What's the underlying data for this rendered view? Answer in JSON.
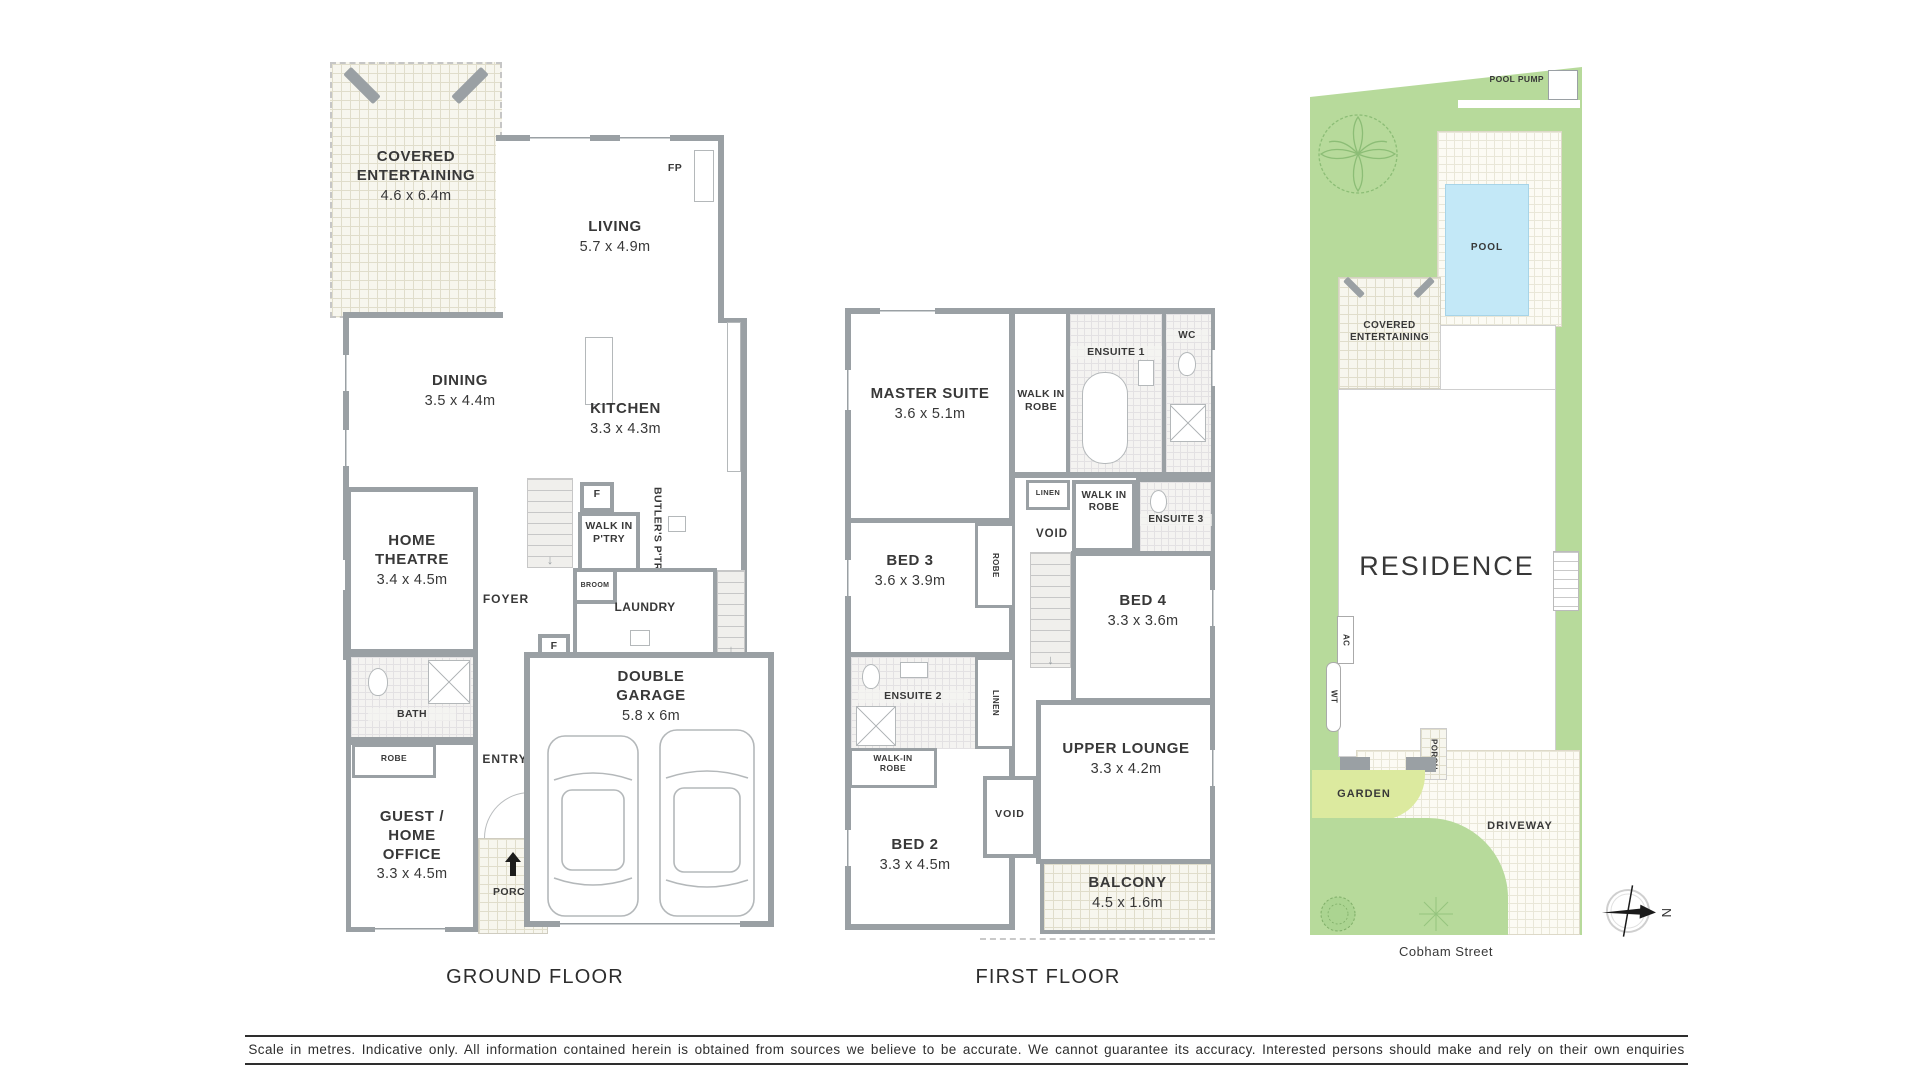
{
  "page": {
    "ground_floor_title": "GROUND FLOOR",
    "first_floor_title": "FIRST FLOOR",
    "street_name": "Cobham Street",
    "compass_north": "N",
    "disclaimer": "Scale in metres. Indicative only. All information contained herein is obtained from sources we believe to be accurate. We cannot guarantee its accuracy. Interested persons should make and rely on their own enquiries"
  },
  "colors": {
    "wall_grey": "#9aa0a4",
    "lawn_green": "#b7da9b",
    "garden_green": "#dcea9f",
    "pool_blue": "#c3e8f7",
    "paving_cream": "#f7f6ee",
    "text_dark": "#383838"
  },
  "ground_floor": {
    "covered_entertaining": {
      "name": "COVERED ENTERTAINING",
      "dims": "4.6 x 6.4m"
    },
    "living": {
      "name": "LIVING",
      "dims": "5.7 x 4.9m"
    },
    "fireplace_label": "FP",
    "dining": {
      "name": "DINING",
      "dims": "3.5 x 4.4m"
    },
    "kitchen": {
      "name": "KITCHEN",
      "dims": "3.3 x 4.3m"
    },
    "fridge_label": "F",
    "walk_in_pantry": "WALK IN P'TRY",
    "butlers_pantry": "BUTLER'S P'TRY",
    "broom": "BROOM",
    "laundry": "LAUNDRY",
    "foyer": "FOYER",
    "home_theatre": {
      "name": "HOME THEATRE",
      "dims": "3.4 x 4.5m"
    },
    "bath": "BATH",
    "robe": "ROBE",
    "guest_home_office": {
      "name": "GUEST / HOME OFFICE",
      "dims": "3.3 x 4.5m"
    },
    "entry": "ENTRY",
    "entry_fixture_label": "F",
    "porch": "PORCH",
    "double_garage": {
      "name": "DOUBLE GARAGE",
      "dims": "5.8 x 6m"
    }
  },
  "first_floor": {
    "master_suite": {
      "name": "MASTER SUITE",
      "dims": "3.6 x 5.1m"
    },
    "walk_in_robe_master": "WALK IN ROBE",
    "ensuite_1": "ENSUITE 1",
    "wc": "WC",
    "linen_upper": "LINEN",
    "walk_in_robe_2": "WALK IN ROBE",
    "ensuite_3": "ENSUITE 3",
    "bed_3": {
      "name": "BED 3",
      "dims": "3.6 x 3.9m"
    },
    "robe_bed3": "ROBE",
    "void_upper": "VOID",
    "bed_4": {
      "name": "BED 4",
      "dims": "3.3 x 3.6m"
    },
    "ensuite_2": "ENSUITE 2",
    "linen_lower": "LINEN",
    "walk_in_robe_bed2": "WALK-IN ROBE",
    "bed_2": {
      "name": "BED 2",
      "dims": "3.3 x 4.5m"
    },
    "void_lower": "VOID",
    "upper_lounge": {
      "name": "UPPER LOUNGE",
      "dims": "3.3 x 4.2m"
    },
    "balcony": {
      "name": "BALCONY",
      "dims": "4.5 x 1.6m"
    }
  },
  "site_plan": {
    "pool_pump": "POOL PUMP",
    "pool": "POOL",
    "covered_entertaining": "COVERED ENTERTAINING",
    "residence": "RESIDENCE",
    "ac": "AC",
    "wt": "WT",
    "porch": "PORCH",
    "garden": "GARDEN",
    "driveway": "DRIVEWAY"
  }
}
